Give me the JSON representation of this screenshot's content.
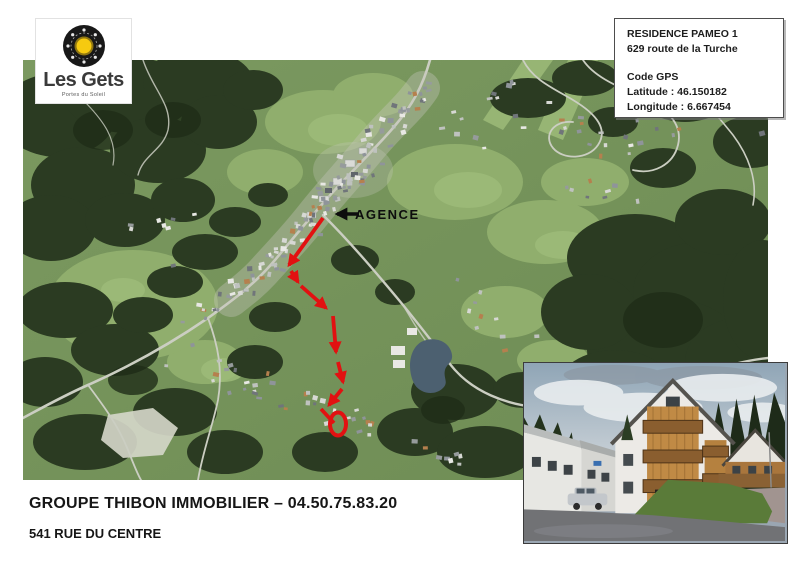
{
  "logo": {
    "name": "Les Gets",
    "tagline": "Portes du Soleil"
  },
  "info_box": {
    "title": "RESIDENCE PAMEO 1",
    "address": "629 route de la Turche",
    "gps_heading": "Code GPS",
    "latitude": "Latitude : 46.150182",
    "longitude": "Longitude : 6.667454"
  },
  "map_annotations": {
    "agence_label": "AGENCE",
    "colors": {
      "route": "#e21111",
      "arrow": "#0d0d0d"
    },
    "agence_arrow": {
      "x1": 336,
      "y1": 154,
      "x2": 314,
      "y2": 154
    },
    "route_segments": [
      {
        "x1": 300,
        "y1": 158,
        "x2": 266,
        "y2": 205
      },
      {
        "x1": 268,
        "y1": 211,
        "x2": 275,
        "y2": 222
      },
      {
        "x1": 278,
        "y1": 226,
        "x2": 303,
        "y2": 248
      },
      {
        "x1": 310,
        "y1": 256,
        "x2": 313,
        "y2": 292
      },
      {
        "x1": 315,
        "y1": 302,
        "x2": 320,
        "y2": 322
      },
      {
        "x1": 319,
        "y1": 329,
        "x2": 306,
        "y2": 345
      }
    ],
    "route_tail": {
      "x1": 298,
      "y1": 349,
      "x2": 311,
      "y2": 363
    },
    "destination_circle": {
      "cx": 315,
      "cy": 364,
      "rx": 8,
      "ry": 11.5
    }
  },
  "footer": {
    "line1": "GROUPE THIBON IMMOBILIER – 04.50.75.83.20",
    "line2": "541 RUE DU CENTRE"
  }
}
